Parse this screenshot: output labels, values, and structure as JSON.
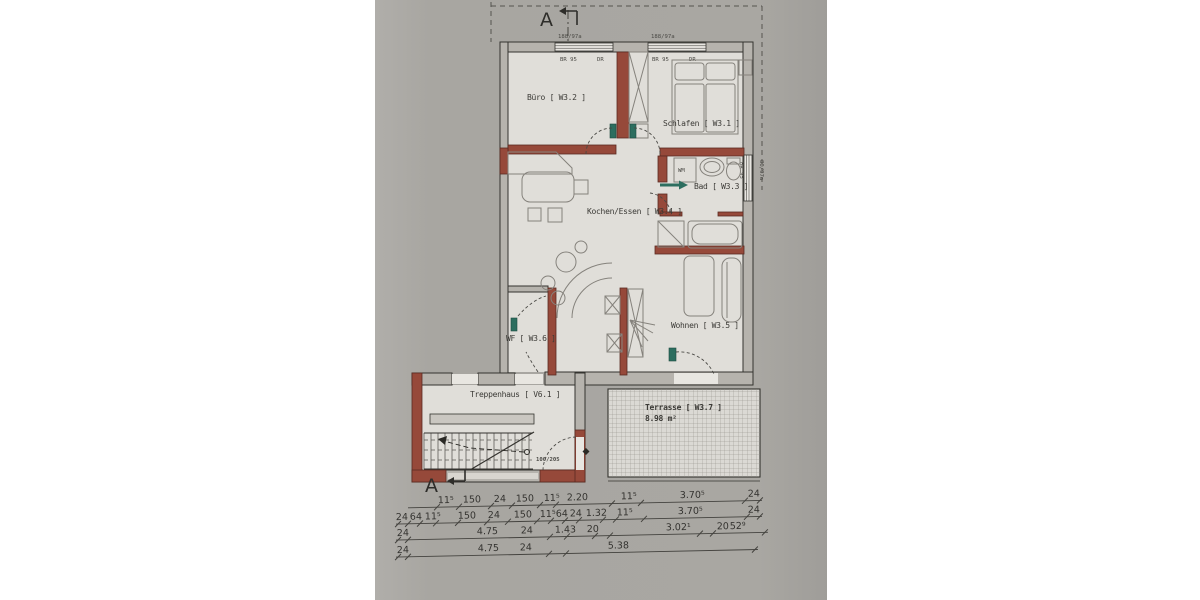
{
  "colors": {
    "photo_bg": "#a9a7a2",
    "paper": "#e0ded9",
    "wall_red": "#96493a",
    "pivot_teal": "#2c6e5f",
    "wall_gray": "#b6b3ad"
  },
  "markers": {
    "section_top": "A",
    "section_bottom": "A"
  },
  "rooms": {
    "buero": "Büro [ W3.2 ]",
    "schlafen": "Schlafen [ W3.1 ]",
    "bad": "Bad [ W3.3 ]",
    "kochen_essen": "Kochen/Essen [ W3.4 ]",
    "wohnen": "Wohnen [ W3.5 ]",
    "wf": "WF [ W3.6 ]",
    "treppenhaus": "Treppenhaus [ V6.1 ]",
    "terrasse": "Terrasse [ W3.7 ]",
    "terrasse_area": "8.98 m²"
  },
  "windows": {
    "top_left_size": "188/97a",
    "top_right_size": "188/97a",
    "right_size": "80/97a",
    "sublabels": [
      "BR 95",
      "DR"
    ]
  },
  "appliances": {
    "washing_machine": "WM"
  },
  "doors": {
    "entrance_size": "100/205"
  },
  "dimensions": {
    "row1": [
      "11⁵",
      "150",
      "24",
      "150",
      "11⁵",
      "2.20",
      "11⁵",
      "3.70⁵",
      "24"
    ],
    "row2": [
      "24",
      "64",
      "11⁵",
      "150",
      "24",
      "150",
      "11⁵",
      "64",
      "24",
      "1.32",
      "11⁵",
      "3.70⁵",
      "24"
    ],
    "row3": [
      "24",
      "4.75",
      "24",
      "1.43",
      "20",
      "3.02¹",
      "20",
      "52⁹"
    ],
    "row4": [
      "24",
      "4.75",
      "24",
      "5.38"
    ]
  }
}
